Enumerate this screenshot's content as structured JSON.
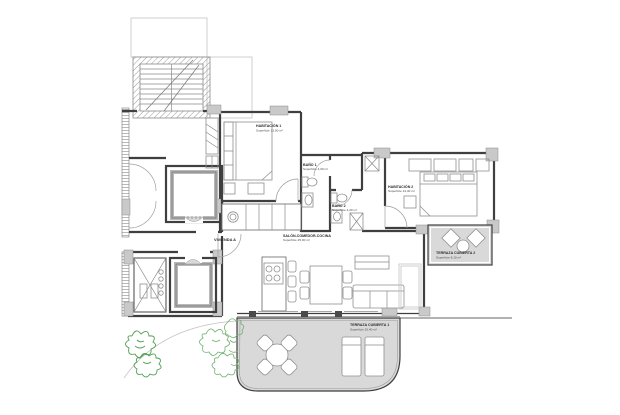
{
  "unit": {
    "label": "VIVIENDA A"
  },
  "rooms": {
    "habitacion1": {
      "name": "HABITACIÓN 1",
      "area": "Superficie 13,00 m²"
    },
    "habitacion2": {
      "name": "HABITACIÓN 2",
      "area": "Superficie 14,40 m²"
    },
    "bano1": {
      "name": "BAÑO 1",
      "area": "Superficie 4,00 m²"
    },
    "bano2": {
      "name": "BAÑO 2",
      "area": "Superficie 4,20 m²"
    },
    "salon": {
      "name": "SALÓN-COMEDOR-COCINA",
      "area": "Superficie 25,90 m²"
    },
    "terraza1": {
      "name": "TERRAZA CUBIERTA 1",
      "area": "Superficie 20,40 m²"
    },
    "terraza2": {
      "name": "TERRAZA CUBIERTA 2",
      "area": "Superficie 8,10 m²"
    }
  },
  "colors": {
    "wall": "#3f3f3f",
    "wall_fill_gray": "#c9c9c9",
    "terrace_fill": "#d9d9d9",
    "faint_line": "#c4c4c4",
    "vegetation": "#4f9e4f",
    "background": "#ffffff"
  }
}
